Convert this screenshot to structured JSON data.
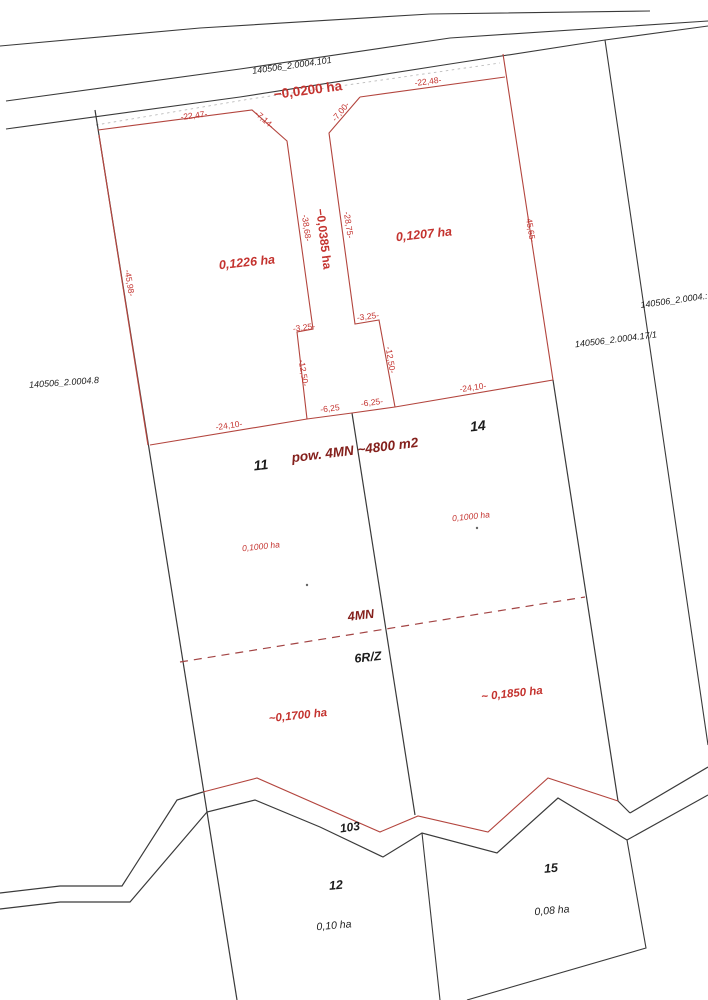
{
  "map": {
    "width": 708,
    "height": 1000,
    "background": "#ffffff",
    "colors": {
      "black_line": "#3a3a3a",
      "red_line": "#b3453e",
      "red_dash_line": "#a34444",
      "gray_dash_line": "#bcbcbc",
      "black_text": "#1c1c1c",
      "red_text": "#c4332f",
      "maroon_text": "#84201c",
      "dot": "#666666"
    },
    "lines": [
      {
        "name": "north-road-outer-line",
        "color": "black",
        "width": 1.1,
        "pts": [
          [
            0,
            46
          ],
          [
            200,
            28
          ],
          [
            430,
            14
          ],
          [
            650,
            11
          ]
        ]
      },
      {
        "name": "north-road-upper-line",
        "color": "black",
        "width": 1.1,
        "pts": [
          [
            6,
            101
          ],
          [
            240,
            69
          ],
          [
            450,
            38
          ],
          [
            708,
            21
          ]
        ]
      },
      {
        "name": "north-road-lower-line",
        "color": "black",
        "width": 1.1,
        "pts": [
          [
            6,
            129
          ],
          [
            240,
            97
          ],
          [
            450,
            64
          ],
          [
            605,
            40
          ],
          [
            708,
            26
          ]
        ]
      },
      {
        "name": "north-gray-dashed-line",
        "color": "grayDash",
        "width": 0.9,
        "dash": "2.5,3.5",
        "pts": [
          [
            96,
            125
          ],
          [
            250,
            99
          ],
          [
            500,
            63
          ]
        ]
      },
      {
        "name": "west-boundary-line",
        "color": "black",
        "width": 1.2,
        "pts": [
          [
            95,
            110
          ],
          [
            237,
            1000
          ]
        ]
      },
      {
        "name": "far-east-boundary-line",
        "color": "black",
        "width": 1.1,
        "pts": [
          [
            605,
            40
          ],
          [
            708,
            745
          ]
        ]
      },
      {
        "name": "east-boundary-black-lower",
        "color": "black",
        "width": 1.2,
        "pts": [
          [
            553,
            380
          ],
          [
            618,
            801
          ],
          [
            630,
            813
          ]
        ]
      },
      {
        "name": "middle-parcel-boundary",
        "color": "black",
        "width": 1.2,
        "pts": [
          [
            352,
            413
          ],
          [
            415,
            815
          ]
        ]
      },
      {
        "name": "southwest-road-upper-line",
        "color": "black",
        "width": 1.2,
        "pts": [
          [
            0,
            893
          ],
          [
            60,
            886
          ],
          [
            122,
            886
          ],
          [
            177,
            800
          ],
          [
            203,
            792
          ]
        ]
      },
      {
        "name": "southwest-road-lower-line",
        "color": "black",
        "width": 1.2,
        "pts": [
          [
            0,
            909
          ],
          [
            60,
            902
          ],
          [
            130,
            902
          ],
          [
            207,
            812
          ],
          [
            255,
            800
          ],
          [
            320,
            827
          ],
          [
            383,
            857
          ],
          [
            422,
            833
          ],
          [
            497,
            853
          ],
          [
            558,
            798
          ],
          [
            627,
            840
          ]
        ]
      },
      {
        "name": "southeast-road-upper-line",
        "color": "black",
        "width": 1.2,
        "pts": [
          [
            630,
            813
          ],
          [
            708,
            767
          ]
        ]
      },
      {
        "name": "southeast-road-lower-line",
        "color": "black",
        "width": 1.2,
        "pts": [
          [
            627,
            840
          ],
          [
            708,
            795
          ]
        ]
      },
      {
        "name": "parcel15-east-boundary",
        "color": "black",
        "width": 1.1,
        "pts": [
          [
            627,
            840
          ],
          [
            646,
            948
          ],
          [
            467,
            1000
          ]
        ]
      },
      {
        "name": "parcel12-15-divider",
        "color": "black",
        "width": 1.1,
        "pts": [
          [
            422,
            833
          ],
          [
            440,
            1000
          ]
        ]
      },
      {
        "name": "west-boundary-red-overlay",
        "color": "red",
        "width": 1.2,
        "pts": [
          [
            99,
            135
          ],
          [
            148,
            445
          ]
        ]
      },
      {
        "name": "north-red-boundary-left-and-pole-west",
        "color": "red",
        "width": 1.1,
        "pts": [
          [
            98,
            130
          ],
          [
            252,
            110
          ],
          [
            287,
            141
          ],
          [
            313,
            329
          ],
          [
            297,
            332
          ],
          [
            307,
            419
          ]
        ]
      },
      {
        "name": "pole-east-red",
        "color": "red",
        "width": 1.1,
        "pts": [
          [
            395,
            407
          ],
          [
            379,
            320
          ],
          [
            355,
            324
          ],
          [
            329,
            133
          ],
          [
            360,
            97
          ]
        ]
      },
      {
        "name": "north-red-boundary-right",
        "color": "red",
        "width": 1.1,
        "pts": [
          [
            360,
            97
          ],
          [
            505,
            77
          ]
        ]
      },
      {
        "name": "east-boundary-red-upper",
        "color": "red",
        "width": 1.1,
        "pts": [
          [
            503,
            54
          ],
          [
            553,
            380
          ]
        ]
      },
      {
        "name": "south-boundary-upper-parcels",
        "color": "red",
        "width": 1.1,
        "pts": [
          [
            150,
            445
          ],
          [
            307,
            419
          ],
          [
            352,
            413
          ],
          [
            395,
            407
          ],
          [
            553,
            380
          ]
        ]
      },
      {
        "name": "zone-dashed-line",
        "color": "redDash",
        "width": 1.2,
        "dash": "8,6",
        "pts": [
          [
            180,
            662
          ],
          [
            585,
            597
          ]
        ]
      },
      {
        "name": "south-road-red-line",
        "color": "red",
        "width": 1.1,
        "pts": [
          [
            203,
            792
          ],
          [
            257,
            778
          ],
          [
            380,
            832
          ],
          [
            418,
            816
          ],
          [
            488,
            832
          ],
          [
            548,
            778
          ],
          [
            618,
            801
          ]
        ]
      }
    ],
    "dots": [
      {
        "name": "survey-dot-1",
        "x": 307,
        "y": 585
      },
      {
        "name": "survey-dot-2",
        "x": 477,
        "y": 528
      }
    ],
    "labels": [
      {
        "name": "parcel-id-101",
        "text": "140506_2.0004.101",
        "x": 292,
        "y": 66,
        "rot": -8,
        "size": 9,
        "color": "black",
        "bold": false,
        "italic": true
      },
      {
        "name": "parcel-id-8",
        "text": "140506_2.0004.8",
        "x": 64,
        "y": 383,
        "rot": -4,
        "size": 9,
        "color": "black",
        "bold": false,
        "italic": true
      },
      {
        "name": "parcel-id-17-1",
        "text": "140506_2.0004.17/1",
        "x": 616,
        "y": 340,
        "rot": -7,
        "size": 9,
        "color": "black",
        "bold": false,
        "italic": true
      },
      {
        "name": "parcel-id-right-edge",
        "text": "140506_2.0004.:",
        "x": 674,
        "y": 301,
        "rot": -8,
        "size": 9,
        "color": "black",
        "bold": false,
        "italic": true
      },
      {
        "name": "parcel-no-11",
        "text": "11",
        "x": 261,
        "y": 466,
        "rot": -6,
        "size": 14,
        "color": "black",
        "bold": true,
        "italic": true
      },
      {
        "name": "parcel-no-14",
        "text": "14",
        "x": 478,
        "y": 427,
        "rot": -6,
        "size": 14,
        "color": "black",
        "bold": true,
        "italic": true
      },
      {
        "name": "zone-6rz",
        "text": "6R/Z",
        "x": 368,
        "y": 658,
        "rot": -6,
        "size": 12.5,
        "color": "black",
        "bold": true,
        "italic": true
      },
      {
        "name": "road-no-103",
        "text": "103",
        "x": 350,
        "y": 828,
        "rot": -8,
        "size": 12,
        "color": "black",
        "bold": true,
        "italic": true
      },
      {
        "name": "parcel-no-12",
        "text": "12",
        "x": 336,
        "y": 886,
        "rot": -5,
        "size": 12.5,
        "color": "black",
        "bold": true,
        "italic": true
      },
      {
        "name": "area-parcel-12",
        "text": "0,10 ha",
        "x": 334,
        "y": 926,
        "rot": -5,
        "size": 10.5,
        "color": "black",
        "bold": false,
        "italic": true
      },
      {
        "name": "parcel-no-15",
        "text": "15",
        "x": 551,
        "y": 869,
        "rot": -5,
        "size": 12.5,
        "color": "black",
        "bold": true,
        "italic": true
      },
      {
        "name": "area-parcel-15",
        "text": "0,08 ha",
        "x": 552,
        "y": 911,
        "rot": -5,
        "size": 10.5,
        "color": "black",
        "bold": false,
        "italic": true
      },
      {
        "name": "area-0200",
        "text": "−0,0200 ha",
        "x": 308,
        "y": 91,
        "rot": -7.5,
        "size": 13.5,
        "color": "red",
        "bold": true,
        "italic": false
      },
      {
        "name": "measure-22-47",
        "text": "-22,47-",
        "x": 194,
        "y": 116,
        "rot": -7.5,
        "size": 8.5,
        "color": "red",
        "bold": false,
        "italic": false
      },
      {
        "name": "measure-22-48",
        "text": "-22,48-",
        "x": 428,
        "y": 82,
        "rot": -7.5,
        "size": 8.5,
        "color": "red",
        "bold": false,
        "italic": false
      },
      {
        "name": "measure-7-14",
        "text": "-7,14-",
        "x": 264,
        "y": 120,
        "rot": 42,
        "size": 8.5,
        "color": "red",
        "bold": false,
        "italic": false
      },
      {
        "name": "measure-7-00",
        "text": "-7,00-",
        "x": 341,
        "y": 112,
        "rot": -50,
        "size": 8.5,
        "color": "red",
        "bold": false,
        "italic": false
      },
      {
        "name": "area-1226",
        "text": "0,1226 ha",
        "x": 247,
        "y": 263,
        "rot": -6,
        "size": 12.5,
        "color": "red",
        "bold": true,
        "italic": true
      },
      {
        "name": "area-1207",
        "text": "0,1207 ha",
        "x": 424,
        "y": 235,
        "rot": -6,
        "size": 12.5,
        "color": "red",
        "bold": true,
        "italic": true
      },
      {
        "name": "area-0385",
        "text": "−0,0385 ha",
        "x": 323,
        "y": 239,
        "rot": 83,
        "size": 12,
        "color": "red",
        "bold": true,
        "italic": false
      },
      {
        "name": "measure-38-68",
        "text": "-38,68-",
        "x": 306,
        "y": 228,
        "rot": 82,
        "size": 8.5,
        "color": "red",
        "bold": false,
        "italic": false
      },
      {
        "name": "measure-28-75",
        "text": "-28,75-",
        "x": 348,
        "y": 225,
        "rot": 82,
        "size": 8.5,
        "color": "red",
        "bold": false,
        "italic": false
      },
      {
        "name": "measure-45-98",
        "text": "-45,98-",
        "x": 129,
        "y": 283,
        "rot": 81,
        "size": 8.5,
        "color": "red",
        "bold": false,
        "italic": false
      },
      {
        "name": "measure-45-65",
        "text": "-45,65-",
        "x": 530,
        "y": 229,
        "rot": 81,
        "size": 8.5,
        "color": "red",
        "bold": false,
        "italic": false
      },
      {
        "name": "measure-3-25-left",
        "text": "-3,25-",
        "x": 304,
        "y": 328,
        "rot": -7,
        "size": 8.5,
        "color": "red",
        "bold": false,
        "italic": false
      },
      {
        "name": "measure-3-25-right",
        "text": "-3,25-",
        "x": 368,
        "y": 317,
        "rot": -7,
        "size": 8.5,
        "color": "red",
        "bold": false,
        "italic": false
      },
      {
        "name": "measure-12-50-left",
        "text": "-12,50-",
        "x": 303,
        "y": 373,
        "rot": 81,
        "size": 8.5,
        "color": "red",
        "bold": false,
        "italic": false
      },
      {
        "name": "measure-12-50-right",
        "text": "-12,50-",
        "x": 390,
        "y": 360,
        "rot": 81,
        "size": 8.5,
        "color": "red",
        "bold": false,
        "italic": false
      },
      {
        "name": "measure-6-25-left",
        "text": "-6,25",
        "x": 330,
        "y": 409,
        "rot": -7,
        "size": 8.5,
        "color": "red",
        "bold": false,
        "italic": false
      },
      {
        "name": "measure-6-25-right",
        "text": "-6,25-",
        "x": 372,
        "y": 403,
        "rot": -7,
        "size": 8.5,
        "color": "red",
        "bold": false,
        "italic": false
      },
      {
        "name": "measure-24-10-left",
        "text": "-24,10-",
        "x": 229,
        "y": 426,
        "rot": -8,
        "size": 8.5,
        "color": "red",
        "bold": false,
        "italic": false
      },
      {
        "name": "measure-24-10-right",
        "text": "-24,10-",
        "x": 473,
        "y": 388,
        "rot": -8,
        "size": 8.5,
        "color": "red",
        "bold": false,
        "italic": false
      },
      {
        "name": "area-1000-left",
        "text": "0,1000 ha",
        "x": 261,
        "y": 547,
        "rot": -6,
        "size": 8.5,
        "color": "red",
        "bold": false,
        "italic": true
      },
      {
        "name": "area-1000-right",
        "text": "0,1000 ha",
        "x": 471,
        "y": 517,
        "rot": -6,
        "size": 8.5,
        "color": "red",
        "bold": false,
        "italic": true
      },
      {
        "name": "area-1700",
        "text": "~0,1700 ha",
        "x": 298,
        "y": 716,
        "rot": -6,
        "size": 11.5,
        "color": "red",
        "bold": true,
        "italic": true
      },
      {
        "name": "area-1850",
        "text": "~ 0,1850 ha",
        "x": 512,
        "y": 694,
        "rot": -6,
        "size": 11.5,
        "color": "red",
        "bold": true,
        "italic": true
      },
      {
        "name": "pow-4mn-4800",
        "text": "pow. 4MN ~4800 m2",
        "x": 355,
        "y": 451,
        "rot": -7,
        "size": 13.5,
        "color": "maroon",
        "bold": true,
        "italic": true
      },
      {
        "name": "zone-4mn",
        "text": "4MN",
        "x": 361,
        "y": 616,
        "rot": -7,
        "size": 12.5,
        "color": "maroon",
        "bold": true,
        "italic": true
      }
    ]
  }
}
